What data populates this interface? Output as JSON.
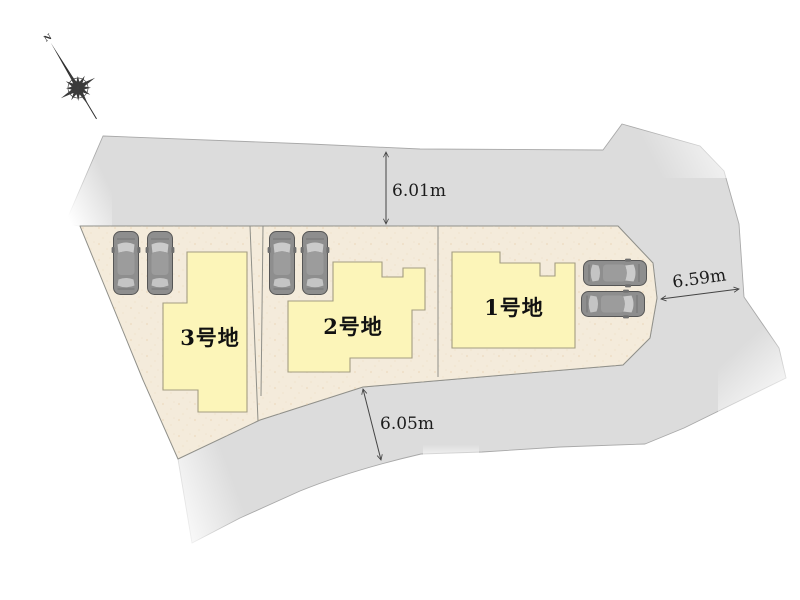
{
  "diagram": {
    "compass": {
      "north_label": "N"
    },
    "lots": [
      {
        "label": "1号地"
      },
      {
        "label": "2号地"
      },
      {
        "label": "3号地"
      }
    ],
    "dimensions": {
      "top": "6.01m",
      "right": "6.59m",
      "bottom": "6.05m"
    },
    "colors": {
      "road": "#dcdcdc",
      "parcel": "#f4ebdb",
      "house_fill": "#fcf5b9",
      "house_stroke": "#a39d82",
      "car_body": "#8e8e8e",
      "car_glass": "#cbcbcb",
      "car_roof": "#9c9c9c"
    }
  }
}
